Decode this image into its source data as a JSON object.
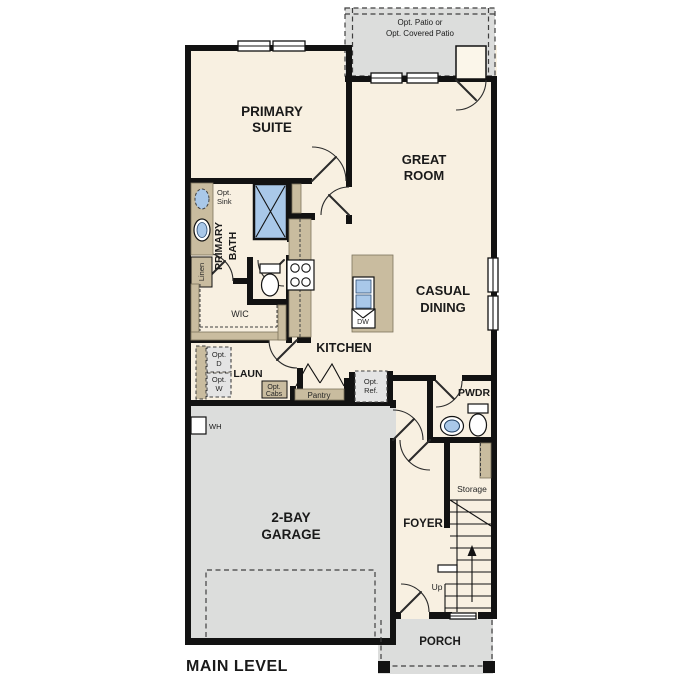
{
  "title": "MAIN LEVEL",
  "colors": {
    "floor": "#f8f0e1",
    "outdoor": "#dcdddc",
    "cabinet": "#c9bc9f",
    "fixture": "#a9c8e9",
    "wall": "#121212",
    "line": "#3f3f3f"
  },
  "labels": {
    "patio_line1": "Opt. Patio or",
    "patio_line2": "Opt. Covered Patio",
    "primary_suite_line1": "PRIMARY",
    "primary_suite_line2": "SUITE",
    "great_room_line1": "GREAT",
    "great_room_line2": "ROOM",
    "casual_dining_line1": "CASUAL",
    "casual_dining_line2": "DINING",
    "kitchen": "KITCHEN",
    "primary_bath_line1": "PRIMARY",
    "primary_bath_line2": "BATH",
    "opt_sink_line1": "Opt.",
    "opt_sink_line2": "Sink",
    "linen": "Linen",
    "wic": "WIC",
    "laundry": "LAUN",
    "opt_d_line1": "Opt.",
    "opt_d_line2": "D",
    "opt_w_line1": "Opt.",
    "opt_w_line2": "W",
    "opt_cabs_line1": "Opt.",
    "opt_cabs_line2": "Cabs",
    "pantry": "Pantry",
    "opt_ref_line1": "Opt.",
    "opt_ref_line2": "Ref.",
    "dw": "DW",
    "wh": "WH",
    "garage_line1": "2-BAY",
    "garage_line2": "GARAGE",
    "pwdr": "PWDR",
    "storage": "Storage",
    "foyer": "FOYER",
    "up": "Up",
    "porch": "PORCH"
  }
}
